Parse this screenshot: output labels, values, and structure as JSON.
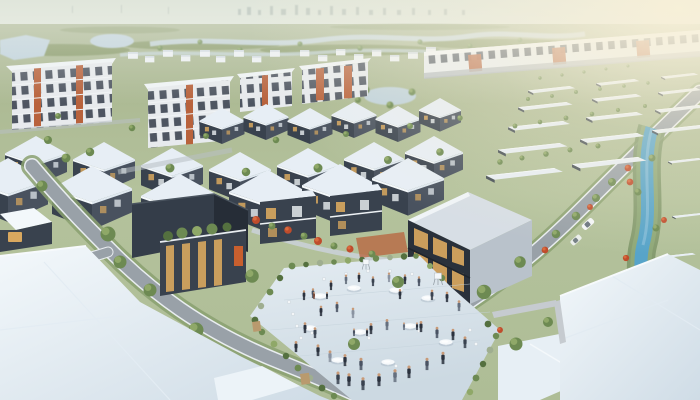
{
  "image_type": "photorealistic 3D aerial rendering of a residential development (no text or UI controls visible)",
  "scene": {
    "setting": "master-planned suburban housing estate spreading across flat green plains",
    "horizon": "hazy pale sky with a faint distant city skyline and low tree lines",
    "background": "wetland ponds and winding water channels; white 3-4 story apartment blocks with brick-orange accent panels; a long row of white townhouses upper right under warm sun glare",
    "midground": "diagonal rows of modern two-story houses with pale blue-white hip roofs and charcoal walls; receding rows of flat-roofed houses separated by street trees on the right; a blue canal with landscaped banks and red flowering shrubs",
    "focal_point": "landscaped courtyard plaza where people mingle around white cafe tables, flanked by a dark two-story glass community building and a flat-roofed building with a rooftop garden",
    "foreground": "large pale house roofs at bottom left and bottom right, curving gray streets with white curbs, green verges, street trees, red flowering trees along a walkway, two parked cars"
  },
  "inventory": {
    "people_approx": 43,
    "round_tables": 10,
    "loose_chairs_approx": 16,
    "pyramid_roof_houses": 19,
    "flat_roof_houses_right": 17,
    "apartment_blocks": 4,
    "townhouse_row_modules_approx": 22,
    "community_buildings": 2,
    "balcony_houses": 2,
    "cars": 2,
    "ponds": 3,
    "canals": 1
  },
  "palette": {
    "sky1": "#e0e6db",
    "sky2": "#edf0e8",
    "glow": "#f8f0d8",
    "ground1": "#a7b48e",
    "ground2": "#b4c29c",
    "treeBand": "#80935f",
    "waterPale": "#bfd2dc",
    "canal": "#57a4c9",
    "roofPale": "#e7eef5",
    "roofBright": "#f3f8fb",
    "roofShade": "#cfdce6",
    "wallDark": "#39424e",
    "wallDarker": "#2a313b",
    "wallMid": "#49525f",
    "white": "#eef2f5",
    "glassWarm": "#d9a85f",
    "orange": "#b8623c",
    "green": "#6d8a52",
    "greenLight": "#8fa868",
    "greenDark": "#54703f",
    "verge": "#8aa070",
    "redTree": "#bf4c2c",
    "redLight": "#d96a3d",
    "road": "#99a1a8",
    "curb": "#e9edf0",
    "paving": "#dae4eb",
    "table": "#f6f9fb",
    "skin": "#c89a78",
    "grayWall": "#c6cbd0",
    "tan": "#b99a6e"
  }
}
